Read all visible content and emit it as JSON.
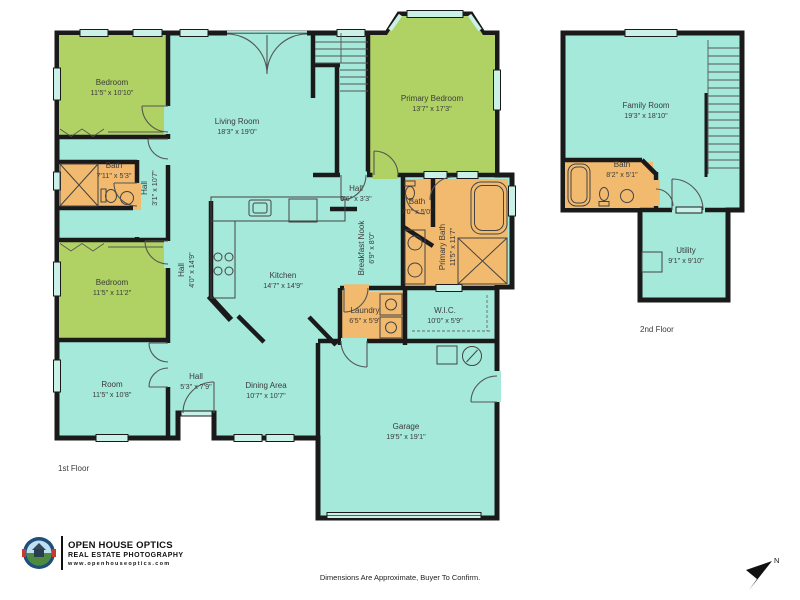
{
  "branding": {
    "company": "OPEN HOUSE OPTICS",
    "tagline": "REAL ESTATE PHOTOGRAPHY",
    "website": "www.openhouseoptics.com"
  },
  "footer": {
    "disclaimer": "Dimensions Are Approximate, Buyer To Confirm."
  },
  "compass": {
    "label": "N"
  },
  "colors": {
    "room_teal": "#a5e9da",
    "room_green": "#b0d264",
    "room_orange": "#f2ba6e",
    "wall": "#1a1a1a",
    "window": "#c9f1e7"
  },
  "floors": [
    {
      "label": "1st Floor",
      "rooms": [
        {
          "id": "bedroom-1",
          "name": "Bedroom",
          "dims": "11'5\" x 10'10\"",
          "x": 112,
          "y": 88,
          "vertical": false
        },
        {
          "id": "living-room",
          "name": "Living Room",
          "dims": "18'3\" x 19'0\"",
          "x": 237,
          "y": 127,
          "vertical": false
        },
        {
          "id": "primary-bedroom",
          "name": "Primary Bedroom",
          "dims": "13'7\" x 17'3\"",
          "x": 432,
          "y": 104,
          "vertical": false
        },
        {
          "id": "bath-1",
          "name": "Bath",
          "dims": "7'11\" x 5'3\"",
          "x": 114,
          "y": 171,
          "vertical": false
        },
        {
          "id": "hall-bedroom-wing",
          "name": "Hall",
          "dims": "3'1\" x 10'7\"",
          "x": 150,
          "y": 188,
          "vertical": true
        },
        {
          "id": "bedroom-2",
          "name": "Bedroom",
          "dims": "11'5\" x 11'2\"",
          "x": 112,
          "y": 288,
          "vertical": false
        },
        {
          "id": "room",
          "name": "Room",
          "dims": "11'5\" x 10'8\"",
          "x": 112,
          "y": 390,
          "vertical": false
        },
        {
          "id": "hall-main",
          "name": "Hall",
          "dims": "4'0\" x 14'9\"",
          "x": 187,
          "y": 270,
          "vertical": true
        },
        {
          "id": "kitchen",
          "name": "Kitchen",
          "dims": "14'7\" x 14'9\"",
          "x": 283,
          "y": 281,
          "vertical": false
        },
        {
          "id": "hall-rear",
          "name": "Hall",
          "dims": "9'6\" x 3'3\"",
          "x": 356,
          "y": 194,
          "vertical": false
        },
        {
          "id": "breakfast-nook",
          "name": "Breakfast Nook",
          "dims": "6'9\" x 8'0\"",
          "x": 367,
          "y": 248,
          "vertical": true
        },
        {
          "id": "bath-2",
          "name": "Bath",
          "dims": "7'0\" x 5'0\"",
          "x": 417,
          "y": 207,
          "vertical": false
        },
        {
          "id": "primary-bath",
          "name": "Primary Bath",
          "dims": "11'5\" x 11'7\"",
          "x": 448,
          "y": 247,
          "vertical": true
        },
        {
          "id": "laundry",
          "name": "Laundry",
          "dims": "6'5\" x 5'9\"",
          "x": 365,
          "y": 316,
          "vertical": false
        },
        {
          "id": "wic",
          "name": "W.I.C.",
          "dims": "10'0\" x 5'9\"",
          "x": 445,
          "y": 316,
          "vertical": false
        },
        {
          "id": "hall-entry",
          "name": "Hall",
          "dims": "5'3\" x 7'9\"",
          "x": 196,
          "y": 382,
          "vertical": false
        },
        {
          "id": "dining-area",
          "name": "Dining Area",
          "dims": "10'7\" x 10'7\"",
          "x": 266,
          "y": 391,
          "vertical": false
        },
        {
          "id": "garage",
          "name": "Garage",
          "dims": "19'5\" x 19'1\"",
          "x": 406,
          "y": 432,
          "vertical": false
        }
      ]
    },
    {
      "label": "2nd Floor",
      "rooms": [
        {
          "id": "family-room",
          "name": "Family Room",
          "dims": "19'3\" x 18'10\"",
          "x": 646,
          "y": 111,
          "vertical": false
        },
        {
          "id": "bath-3",
          "name": "Bath",
          "dims": "8'2\" x 5'1\"",
          "x": 622,
          "y": 170,
          "vertical": false
        },
        {
          "id": "utility",
          "name": "Utility",
          "dims": "9'1\" x 9'10\"",
          "x": 686,
          "y": 256,
          "vertical": false
        }
      ]
    }
  ]
}
